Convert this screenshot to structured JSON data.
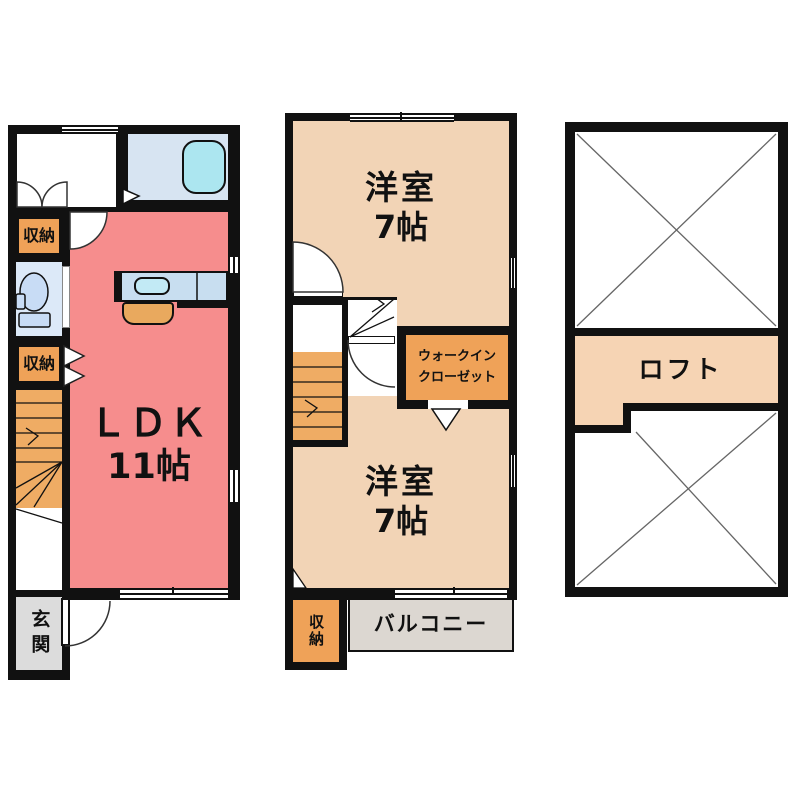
{
  "plan_1f": {
    "ldk_name": "ＬＤＫ",
    "ldk_size": "11帖",
    "storage_top": "収納",
    "storage_mid": "収納",
    "entrance": "玄関"
  },
  "plan_2f": {
    "bedroom_top_name": "洋室",
    "bedroom_top_size": "7帖",
    "bedroom_bottom_name": "洋室",
    "bedroom_bottom_size": "7帖",
    "wic_line1": "ウォークイン",
    "wic_line2": "クローゼット",
    "storage": "収納",
    "balcony": "バルコニー"
  },
  "plan_loft": {
    "loft": "ロフト"
  },
  "colors": {
    "wall": "#111111",
    "ldk": "#F68D8D",
    "bedroom": "#F2D4B6",
    "loft": "#F6D4B4",
    "storage": "#EFA258",
    "stairs": "#EFAC64",
    "bathroom": "#D7E4F2",
    "bathtub": "#ACE6F0",
    "toilet_room": "#DCE9F8",
    "toilet": "#C8DCF5",
    "entrance_gray": "#DCDCDC",
    "balcony_gray": "#DCD7D1",
    "counter": "#C8DEF0",
    "sink": "#C2EAF5",
    "island": "#E9A95E"
  }
}
